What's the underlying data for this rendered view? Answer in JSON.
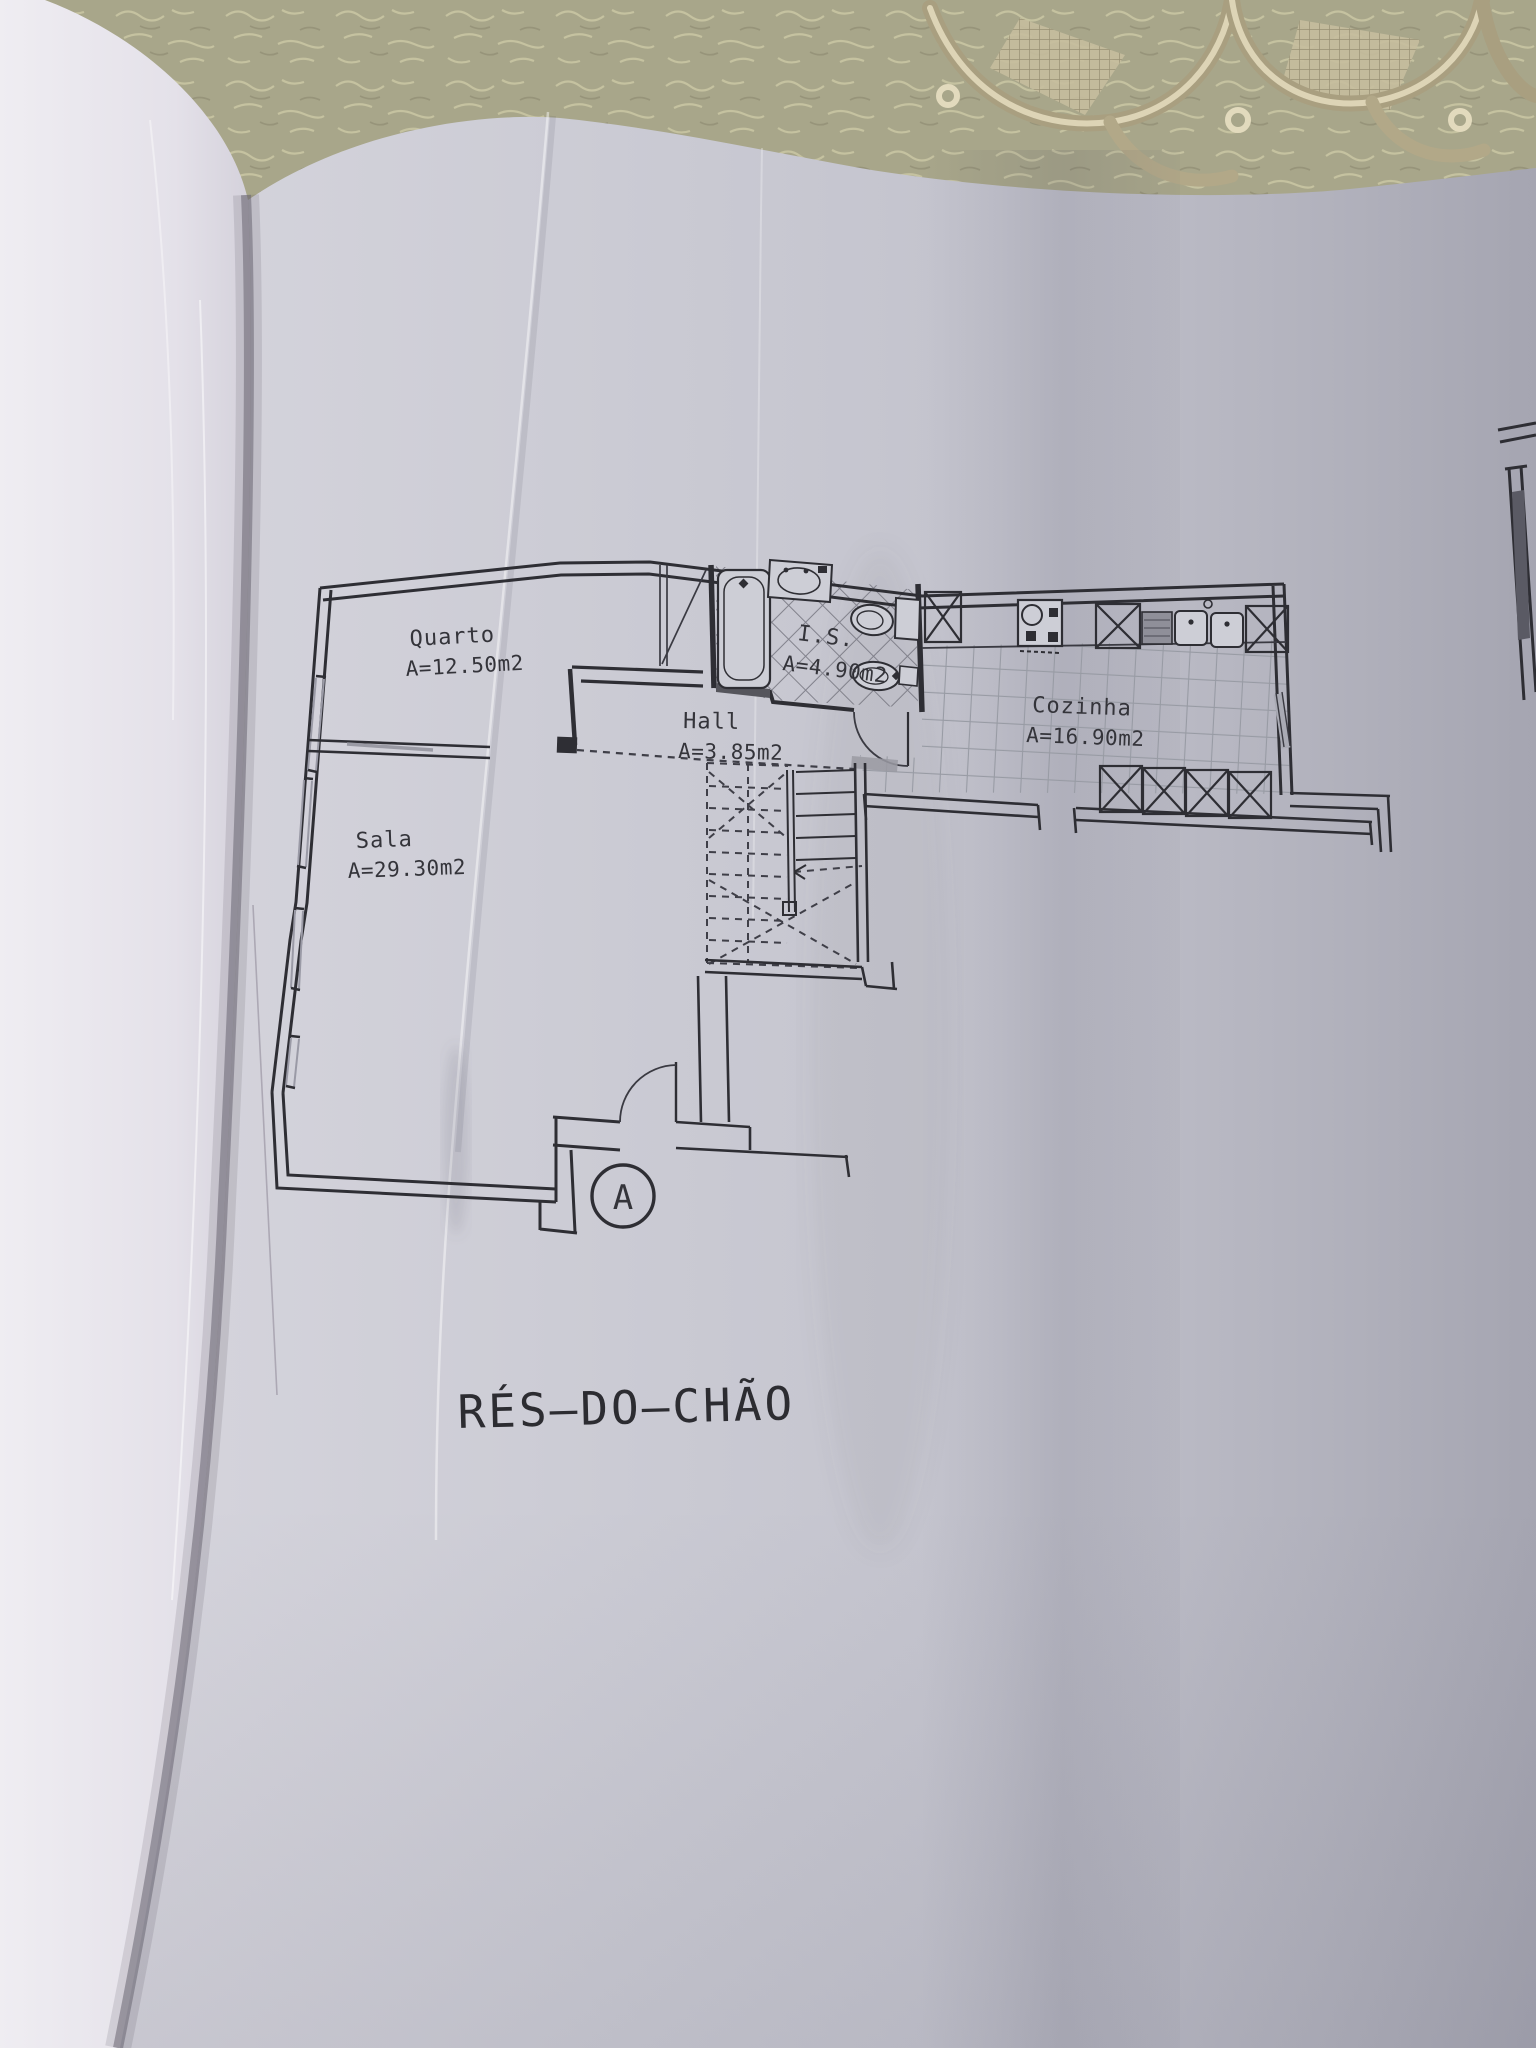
{
  "scene": {
    "floor_title": "RÉS–DO–CHÃO",
    "section_marker": "A"
  },
  "rooms": [
    {
      "name": "Quarto",
      "area": "A=12.50m2"
    },
    {
      "name": "Sala",
      "area": "A=29.30m2"
    },
    {
      "name": "Hall",
      "area": "A=3.85m2"
    },
    {
      "name": "I.S.",
      "area": "A=4.90m2"
    },
    {
      "name": "Cozinha",
      "area": "A=16.90m2"
    }
  ],
  "colors": {
    "paper_right": "#c9c9d2",
    "paper_left": "#e9e7ee",
    "ink": "#2e2e34",
    "tablecloth": "#a8a68a",
    "lace": "#cfc5a6"
  }
}
